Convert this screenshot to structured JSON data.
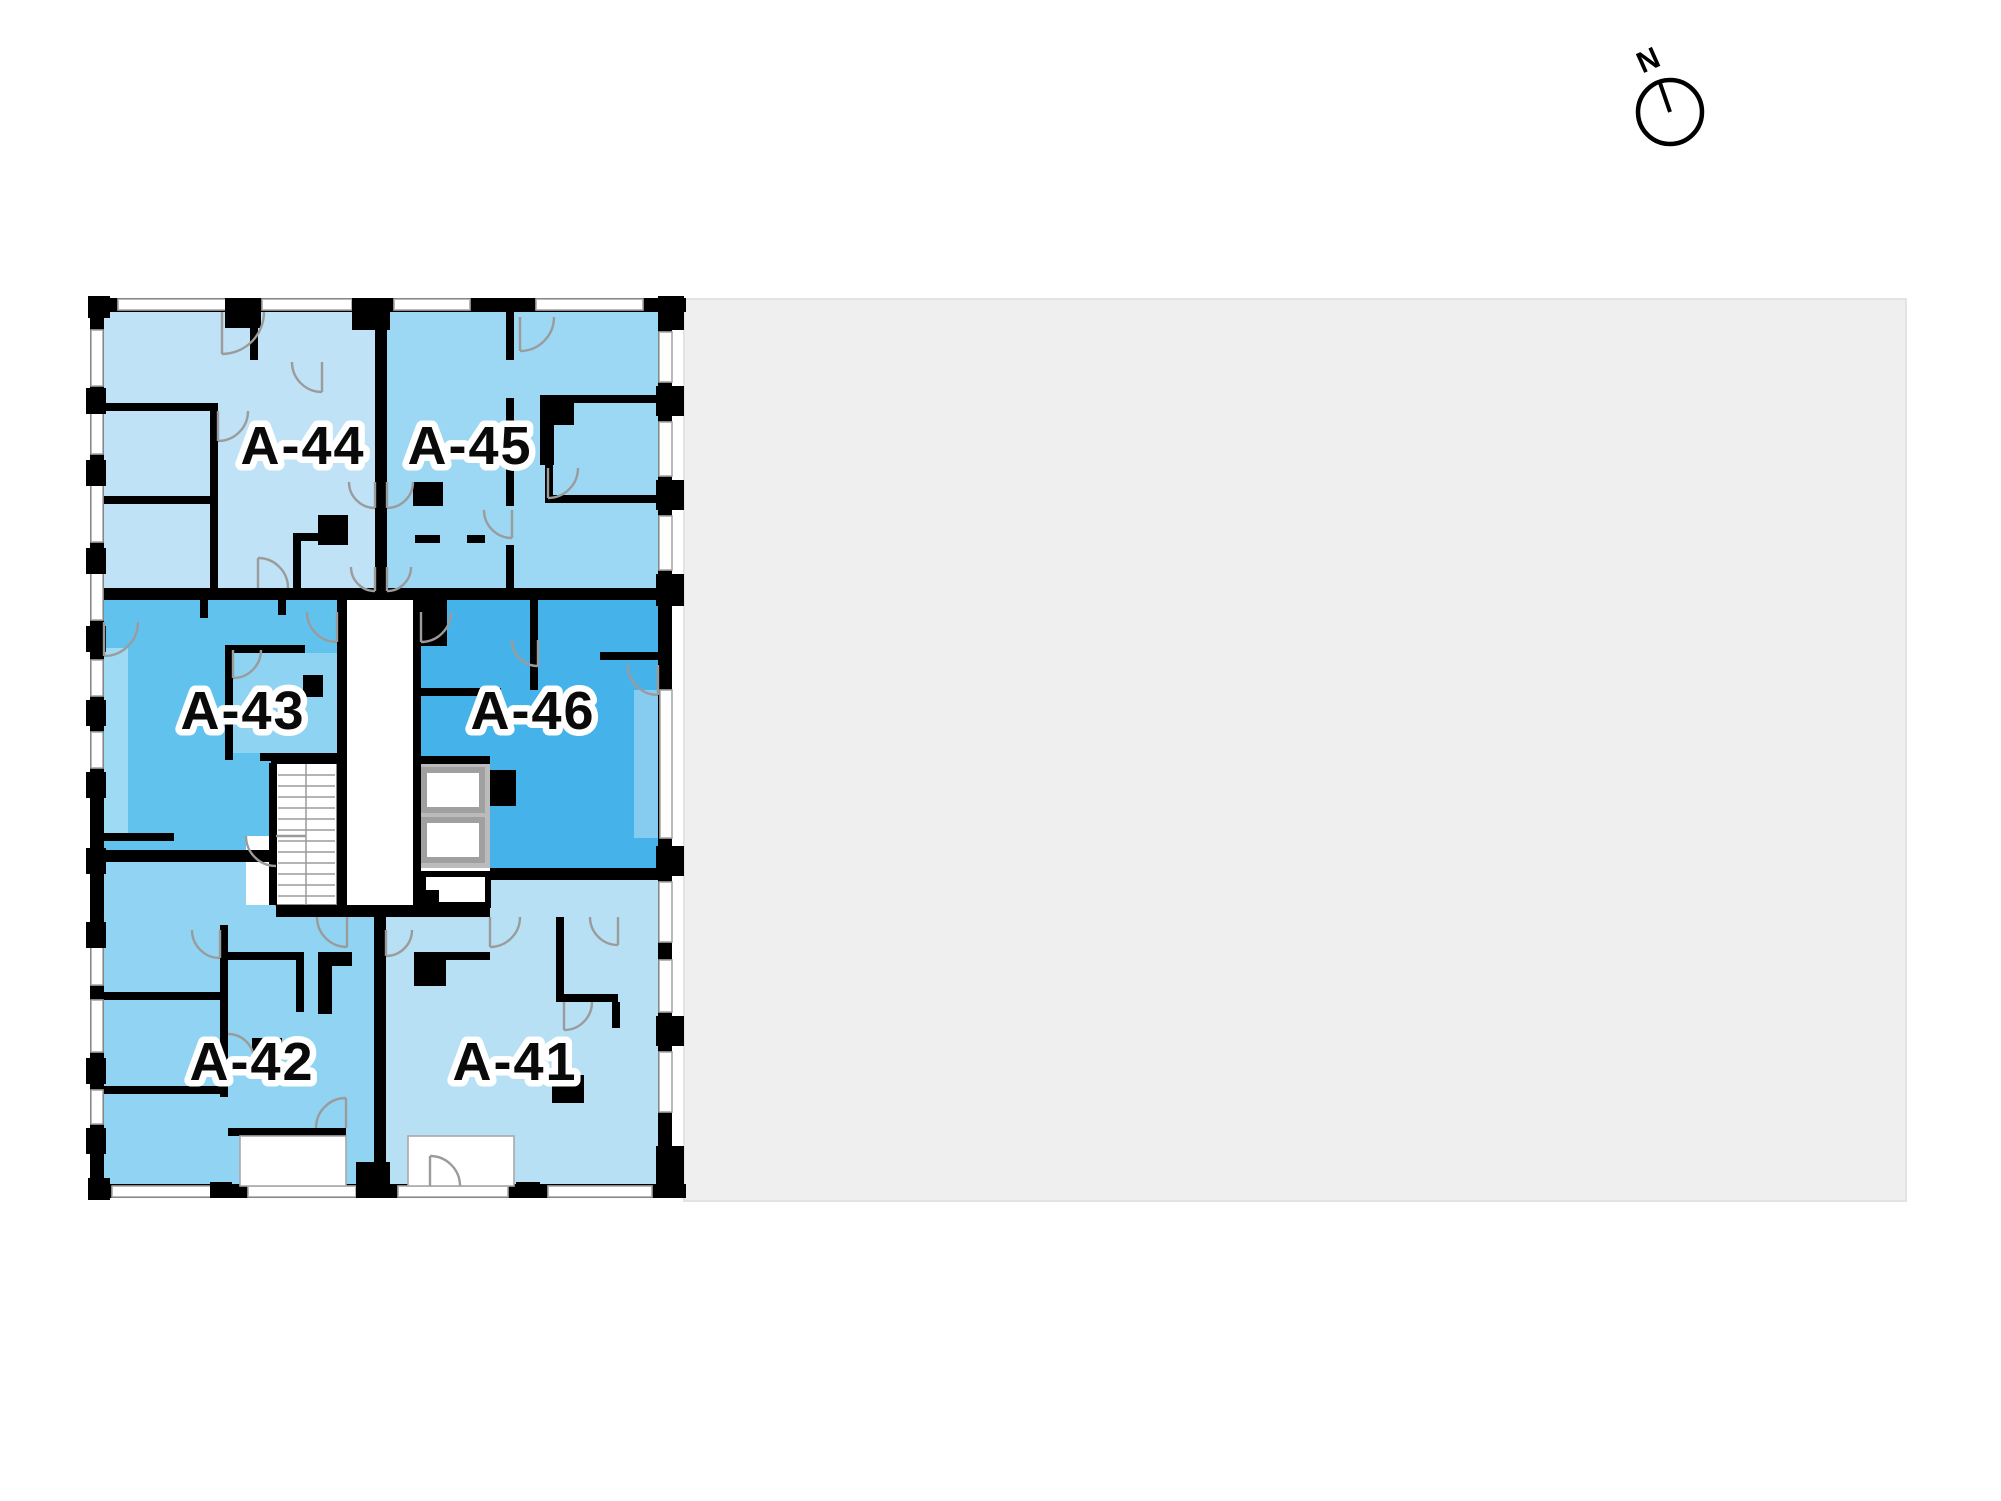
{
  "page": {
    "background": "#ffffff"
  },
  "site_plan": {
    "area_fill": "#efefef",
    "area_stroke": "#e3e3e3"
  },
  "floor_plan": {
    "wall_color": "#000000",
    "window_stroke": "#a9a9a9",
    "door_stroke": "#9b9b9b",
    "label_fill": "#0a0a0a",
    "label_outline": "#ffffff",
    "core": {
      "stairs_fill": "#ffffff",
      "stairs_outline": "#8b8b8b",
      "elevator_pocket_fill": "#bbbbbb",
      "elevator_fill": "#ffffff",
      "elevator_stroke": "#a0a0a0"
    },
    "units": [
      {
        "id": "A-44",
        "label": "A-44",
        "color": "#bfe2f6",
        "label_x": 303,
        "label_y": 464
      },
      {
        "id": "A-45",
        "label": "A-45",
        "color": "#9cd7f3",
        "label_x": 470,
        "label_y": 464
      },
      {
        "id": "A-43",
        "label": "A-43",
        "color": "#62c2ee",
        "label_x": 243,
        "label_y": 729
      },
      {
        "id": "A-46",
        "label": "A-46",
        "color": "#45b3ea",
        "label_x": 533,
        "label_y": 729
      },
      {
        "id": "A-42",
        "label": "A-42",
        "color": "#90d3f2",
        "label_x": 252,
        "label_y": 1080
      },
      {
        "id": "A-41",
        "label": "A-41",
        "color": "#b7e0f5",
        "label_x": 515,
        "label_y": 1080
      }
    ],
    "sub_tints": {
      "a43_inner_room": "#8ed3f2",
      "a43_left_balcony": "#9edaf4",
      "a46_right_balcony": "#85ccf0"
    }
  },
  "compass": {
    "label": "N"
  }
}
